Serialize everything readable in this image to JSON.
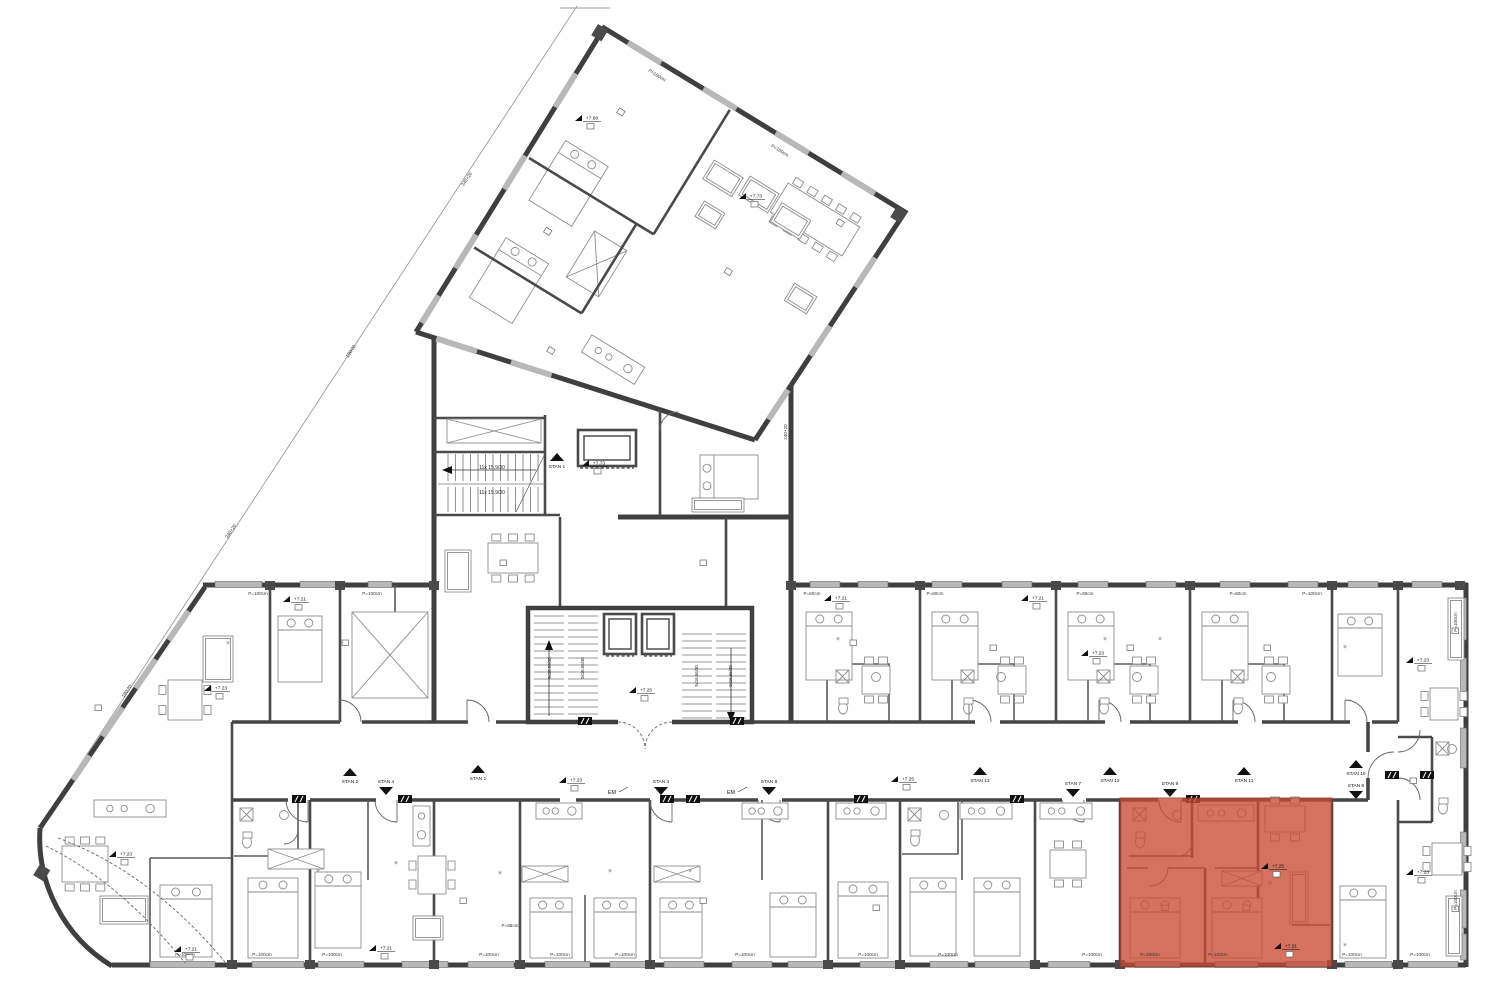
{
  "meta": {
    "drawing_type": "apartment building floor plan",
    "highlight_color": "#c94a33",
    "highlight_opacity": 0.78,
    "wall_color": "#3f3f3f",
    "window_color": "#b8b8b8"
  },
  "highlight": {
    "x": 1120,
    "y": 798,
    "w": 212,
    "h": 169
  },
  "stair_texts": {
    "upper": [
      {
        "text": "11x 15.9/30",
        "x": 492,
        "y": 469
      },
      {
        "text": "11x 15.9/30",
        "x": 492,
        "y": 494
      }
    ],
    "core": [
      {
        "text": "9x16.66/30",
        "x": 551,
        "y": 668
      },
      {
        "text": "9x16.66/30",
        "x": 584,
        "y": 668
      },
      {
        "text": "9x16.66/30",
        "x": 698,
        "y": 676
      },
      {
        "text": "9x16.66/30",
        "x": 732,
        "y": 676
      }
    ]
  },
  "stan_markers": [
    {
      "label": "STAN 2",
      "dir": "up",
      "x": 350,
      "y": 776
    },
    {
      "label": "STAN 1",
      "dir": "up",
      "x": 478,
      "y": 773
    },
    {
      "label": "STAN 13",
      "dir": "up",
      "x": 980,
      "y": 775
    },
    {
      "label": "STAN 12",
      "dir": "up",
      "x": 1110,
      "y": 775
    },
    {
      "label": "STAN 11",
      "dir": "up",
      "x": 1244,
      "y": 775
    },
    {
      "label": "STAN 10",
      "dir": "up",
      "x": 1356,
      "y": 768
    },
    {
      "label": "STAN 1",
      "dir": "up",
      "x": 557,
      "y": 461
    },
    {
      "label": "STAN 4",
      "dir": "down",
      "x": 386,
      "y": 787
    },
    {
      "label": "STAN 3",
      "dir": "down",
      "x": 661,
      "y": 787
    },
    {
      "label": "STAN 8",
      "dir": "down",
      "x": 769,
      "y": 787
    },
    {
      "label": "STAN 7",
      "dir": "down",
      "x": 1073,
      "y": 789
    },
    {
      "label": "STAN 9",
      "dir": "down",
      "x": 1170,
      "y": 789
    },
    {
      "label": "STAN 6",
      "dir": "down",
      "x": 1356,
      "y": 791
    }
  ],
  "elevation_markers": [
    {
      "label": "+7.73",
      "x": 591,
      "y": 463
    },
    {
      "label": "+7.73",
      "x": 748,
      "y": 196
    },
    {
      "label": "+7.68",
      "x": 584,
      "y": 118
    },
    {
      "label": "+7.23",
      "x": 568,
      "y": 780
    },
    {
      "label": "+7.25",
      "x": 900,
      "y": 779
    },
    {
      "label": "+7.25",
      "x": 638,
      "y": 690
    },
    {
      "label": "+7.23",
      "x": 118,
      "y": 854
    },
    {
      "label": "+7.21",
      "x": 183,
      "y": 949
    },
    {
      "label": "+7.21",
      "x": 292,
      "y": 599
    },
    {
      "label": "+7.21",
      "x": 833,
      "y": 598
    },
    {
      "label": "+7.21",
      "x": 1030,
      "y": 598
    },
    {
      "label": "+7.23",
      "x": 1090,
      "y": 653
    },
    {
      "label": "+7.25",
      "x": 1270,
      "y": 866
    },
    {
      "label": "+7.21",
      "x": 1283,
      "y": 946
    },
    {
      "label": "+7.23",
      "x": 1415,
      "y": 660
    },
    {
      "label": "+7.23",
      "x": 1415,
      "y": 872
    },
    {
      "label": "+7.23",
      "x": 213,
      "y": 688
    },
    {
      "label": "+7.21",
      "x": 378,
      "y": 948
    }
  ],
  "em_labels": [
    {
      "text": "EM",
      "x": 612,
      "y": 794
    },
    {
      "text": "EM",
      "x": 731,
      "y": 794
    }
  ],
  "wall_texts": [
    {
      "text": "P=100cm",
      "x": 185,
      "y": 956,
      "rot": 0
    },
    {
      "text": "P=100cm",
      "x": 262,
      "y": 956,
      "rot": 0
    },
    {
      "text": "P=100cm",
      "x": 332,
      "y": 956,
      "rot": 0
    },
    {
      "text": "P=100cm",
      "x": 489,
      "y": 956,
      "rot": 0
    },
    {
      "text": "P=100cm",
      "x": 560,
      "y": 956,
      "rot": 0
    },
    {
      "text": "P=100cm",
      "x": 625,
      "y": 956,
      "rot": 0
    },
    {
      "text": "P=100cm",
      "x": 745,
      "y": 956,
      "rot": 0
    },
    {
      "text": "P=100cm",
      "x": 868,
      "y": 956,
      "rot": 0
    },
    {
      "text": "P=100cm",
      "x": 948,
      "y": 956,
      "rot": 0
    },
    {
      "text": "P=100cm",
      "x": 1092,
      "y": 956,
      "rot": 0
    },
    {
      "text": "P=100cm",
      "x": 1150,
      "y": 956,
      "rot": 0
    },
    {
      "text": "P=100cm",
      "x": 1218,
      "y": 956,
      "rot": 0
    },
    {
      "text": "P=100cm",
      "x": 1352,
      "y": 956,
      "rot": 0
    },
    {
      "text": "P=100cm",
      "x": 1420,
      "y": 956,
      "rot": 0
    },
    {
      "text": "P=85cm",
      "x": 510,
      "y": 927,
      "rot": 0
    },
    {
      "text": "P=60cm",
      "x": 812,
      "y": 595,
      "rot": 0
    },
    {
      "text": "P=60cm",
      "x": 935,
      "y": 595,
      "rot": 0
    },
    {
      "text": "P=60cm",
      "x": 1085,
      "y": 595,
      "rot": 0
    },
    {
      "text": "P=60cm",
      "x": 1238,
      "y": 595,
      "rot": 0
    },
    {
      "text": "P=100cm",
      "x": 1312,
      "y": 595,
      "rot": 0
    },
    {
      "text": "P=100cm",
      "x": 258,
      "y": 595,
      "rot": 0
    },
    {
      "text": "P=100cm",
      "x": 372,
      "y": 595,
      "rot": 0
    },
    {
      "text": "P=100cm",
      "x": 1457,
      "y": 622,
      "rot": -90
    },
    {
      "text": "P=100cm",
      "x": 1457,
      "y": 900,
      "rot": -90
    },
    {
      "text": "240+20",
      "x": 468,
      "y": 180,
      "rot": -56
    },
    {
      "text": "180/20",
      "x": 352,
      "y": 352,
      "rot": -56
    },
    {
      "text": "240+20",
      "x": 232,
      "y": 532,
      "rot": -56
    },
    {
      "text": "180/20",
      "x": 128,
      "y": 692,
      "rot": -56
    },
    {
      "text": "240+20",
      "x": 787,
      "y": 432,
      "rot": -90
    }
  ],
  "wing_texts": [
    {
      "text": "P=100cm",
      "u": 70,
      "v": 14
    },
    {
      "text": "P=100cm",
      "u": 214,
      "v": 14
    }
  ],
  "windows": {
    "south": [
      [
        150,
        215
      ],
      [
        252,
        304
      ],
      [
        318,
        364
      ],
      [
        402,
        448
      ],
      [
        468,
        514
      ],
      [
        545,
        590
      ],
      [
        610,
        646
      ],
      [
        664,
        704
      ],
      [
        732,
        772
      ],
      [
        788,
        824
      ],
      [
        860,
        896
      ],
      [
        930,
        968
      ],
      [
        975,
        1030
      ],
      [
        1048,
        1090
      ],
      [
        1135,
        1180
      ],
      [
        1215,
        1258
      ],
      [
        1286,
        1328
      ],
      [
        1345,
        1392
      ],
      [
        1408,
        1458
      ]
    ],
    "north": [
      [
        215,
        262
      ],
      [
        300,
        336
      ],
      [
        368,
        392
      ],
      [
        810,
        840
      ],
      [
        858,
        888
      ],
      [
        932,
        962
      ],
      [
        1002,
        1032
      ],
      [
        1078,
        1108
      ],
      [
        1146,
        1176
      ],
      [
        1220,
        1250
      ],
      [
        1288,
        1318
      ],
      [
        1348,
        1378
      ],
      [
        1412,
        1442
      ]
    ],
    "east": [
      [
        598,
        640
      ],
      [
        658,
        700
      ],
      [
        728,
        768
      ],
      [
        832,
        872
      ],
      [
        890,
        928
      ],
      [
        934,
        960
      ]
    ],
    "diag": [
      [
        0.1,
        0.22
      ],
      [
        0.3,
        0.42
      ],
      [
        0.5,
        0.62
      ],
      [
        0.7,
        0.8
      ]
    ],
    "wing_top": [
      [
        0.08,
        0.19
      ],
      [
        0.33,
        0.44
      ],
      [
        0.57,
        0.68
      ],
      [
        0.79,
        0.9
      ]
    ],
    "wing_left": [
      [
        0.15,
        0.26
      ],
      [
        0.42,
        0.53
      ],
      [
        0.68,
        0.79
      ],
      [
        0.88,
        0.97
      ]
    ],
    "wing_right": [
      [
        0.2,
        0.33
      ],
      [
        0.5,
        0.63
      ],
      [
        0.78,
        0.91
      ]
    ],
    "wing_bottom": [
      [
        0.06,
        0.18
      ],
      [
        0.28,
        0.4
      ]
    ]
  },
  "piers": {
    "south": [
      232,
      310,
      434,
      520,
      650,
      828,
      900,
      1035,
      1120,
      1332,
      1398
    ],
    "north": [
      270,
      340,
      434,
      791,
      920,
      1056,
      1190,
      1332,
      1398,
      1460
    ]
  },
  "doors": {
    "south_x": [
      297,
      386,
      661,
      769,
      1073,
      1170
    ],
    "north_x": [
      350,
      478,
      980,
      1110,
      1244,
      1356
    ]
  },
  "ducts": [
    [
      292,
      795
    ],
    [
      398,
      795
    ],
    [
      660,
      795
    ],
    [
      686,
      795
    ],
    [
      854,
      795
    ],
    [
      1010,
      795
    ],
    [
      1186,
      795
    ],
    [
      1385,
      771
    ],
    [
      1420,
      771
    ],
    [
      578,
      717
    ],
    [
      730,
      717
    ]
  ],
  "room_tags": [
    [
      500,
      560
    ],
    [
      700,
      560
    ],
    [
      850,
      640
    ],
    [
      990,
      645
    ],
    [
      1127,
      645
    ],
    [
      1264,
      645
    ],
    [
      460,
      898
    ],
    [
      700,
      898
    ],
    [
      342,
      640
    ],
    [
      95,
      705
    ],
    [
      1162,
      905
    ],
    [
      1243,
      905
    ],
    [
      873,
      905
    ],
    [
      1410,
      778
    ],
    [
      1452,
      628
    ],
    [
      1452,
      906
    ]
  ],
  "wing_room_tags": [
    [
      55,
      60
    ],
    [
      55,
      200
    ],
    [
      230,
      140
    ],
    [
      300,
      40
    ],
    [
      120,
      300
    ]
  ],
  "furniture": [
    {
      "t": "bed",
      "x": 160,
      "y": 885,
      "w": 52,
      "h": 72
    },
    {
      "t": "bed",
      "x": 248,
      "y": 878,
      "w": 50,
      "h": 80
    },
    {
      "t": "bed",
      "x": 315,
      "y": 872,
      "w": 46,
      "h": 76
    },
    {
      "t": "bed",
      "x": 530,
      "y": 898,
      "w": 42,
      "h": 60
    },
    {
      "t": "bed",
      "x": 594,
      "y": 898,
      "w": 42,
      "h": 60
    },
    {
      "t": "bed",
      "x": 660,
      "y": 898,
      "w": 42,
      "h": 60
    },
    {
      "t": "bed",
      "x": 770,
      "y": 893,
      "w": 46,
      "h": 64
    },
    {
      "t": "bed",
      "x": 838,
      "y": 882,
      "w": 50,
      "h": 76
    },
    {
      "t": "bed",
      "x": 910,
      "y": 878,
      "w": 46,
      "h": 78
    },
    {
      "t": "bed",
      "x": 974,
      "y": 878,
      "w": 46,
      "h": 78
    },
    {
      "t": "bed",
      "x": 1130,
      "y": 898,
      "w": 50,
      "h": 60
    },
    {
      "t": "bed",
      "x": 1212,
      "y": 898,
      "w": 50,
      "h": 60
    },
    {
      "t": "bed",
      "x": 1340,
      "y": 886,
      "w": 46,
      "h": 72
    },
    {
      "t": "bed",
      "x": 806,
      "y": 612,
      "w": 46,
      "h": 68
    },
    {
      "t": "bed",
      "x": 932,
      "y": 612,
      "w": 46,
      "h": 68
    },
    {
      "t": "bed",
      "x": 1068,
      "y": 612,
      "w": 46,
      "h": 68
    },
    {
      "t": "bed",
      "x": 1202,
      "y": 612,
      "w": 46,
      "h": 68
    },
    {
      "t": "bed",
      "x": 1338,
      "y": 614,
      "w": 44,
      "h": 62
    },
    {
      "t": "bed",
      "x": 278,
      "y": 616,
      "w": 44,
      "h": 66
    },
    {
      "t": "bed",
      "x": 700,
      "y": 455,
      "w": 58,
      "h": 44
    },
    {
      "t": "table",
      "x": 62,
      "y": 846,
      "w": 46,
      "h": 36,
      "ch": 6
    },
    {
      "t": "table",
      "x": 168,
      "y": 680,
      "w": 34,
      "h": 40,
      "ch": 4
    },
    {
      "t": "table",
      "x": 418,
      "y": 856,
      "w": 28,
      "h": 38,
      "ch": 4
    },
    {
      "t": "table",
      "x": 488,
      "y": 543,
      "w": 50,
      "h": 30,
      "ch": 6
    },
    {
      "t": "table",
      "x": 862,
      "y": 666,
      "w": 28,
      "h": 28,
      "ch": 4
    },
    {
      "t": "table",
      "x": 998,
      "y": 666,
      "w": 28,
      "h": 28,
      "ch": 4
    },
    {
      "t": "table",
      "x": 1130,
      "y": 666,
      "w": 28,
      "h": 28,
      "ch": 4
    },
    {
      "t": "table",
      "x": 1262,
      "y": 666,
      "w": 28,
      "h": 28,
      "ch": 4
    },
    {
      "t": "table",
      "x": 1050,
      "y": 850,
      "w": 36,
      "h": 28,
      "ch": 4
    },
    {
      "t": "table",
      "x": 1265,
      "y": 806,
      "w": 40,
      "h": 26,
      "ch": 4
    },
    {
      "t": "table",
      "x": 1432,
      "y": 843,
      "w": 30,
      "h": 32,
      "ch": 4
    },
    {
      "t": "table",
      "x": 1430,
      "y": 688,
      "w": 28,
      "h": 32,
      "ch": 4
    },
    {
      "t": "sofa",
      "x": 203,
      "y": 636,
      "w": 30,
      "h": 46
    },
    {
      "t": "sofa",
      "x": 100,
      "y": 896,
      "w": 48,
      "h": 28
    },
    {
      "t": "sofa",
      "x": 445,
      "y": 550,
      "w": 26,
      "h": 42
    },
    {
      "t": "sofa",
      "x": 413,
      "y": 916,
      "w": 30,
      "h": 24
    },
    {
      "t": "sofa",
      "x": 1448,
      "y": 598,
      "w": 16,
      "h": 62
    },
    {
      "t": "sofa",
      "x": 1446,
      "y": 896,
      "w": 16,
      "h": 60
    },
    {
      "t": "sofa",
      "x": 1290,
      "y": 872,
      "w": 18,
      "h": 52
    },
    {
      "t": "sofa",
      "x": 692,
      "y": 498,
      "w": 52,
      "h": 14
    },
    {
      "t": "kitchen",
      "x": 94,
      "y": 800,
      "w": 72,
      "h": 17
    },
    {
      "t": "kitchen",
      "x": 413,
      "y": 806,
      "w": 17,
      "h": 40
    },
    {
      "t": "kitchen",
      "x": 536,
      "y": 803,
      "w": 46,
      "h": 16
    },
    {
      "t": "kitchen",
      "x": 742,
      "y": 803,
      "w": 46,
      "h": 16
    },
    {
      "t": "kitchen",
      "x": 836,
      "y": 803,
      "w": 50,
      "h": 16
    },
    {
      "t": "kitchen",
      "x": 960,
      "y": 803,
      "w": 52,
      "h": 16
    },
    {
      "t": "kitchen",
      "x": 1040,
      "y": 803,
      "w": 52,
      "h": 16
    },
    {
      "t": "kitchen",
      "x": 1198,
      "y": 805,
      "w": 56,
      "h": 16
    },
    {
      "t": "ward",
      "x": 268,
      "y": 849,
      "w": 56,
      "h": 20
    },
    {
      "t": "ward",
      "x": 352,
      "y": 612,
      "w": 76,
      "h": 86
    },
    {
      "t": "ward",
      "x": 447,
      "y": 419,
      "w": 94,
      "h": 24
    },
    {
      "t": "ward",
      "x": 1222,
      "y": 871,
      "w": 40,
      "h": 15
    },
    {
      "t": "ward",
      "x": 522,
      "y": 866,
      "w": 46,
      "h": 16
    },
    {
      "t": "ward",
      "x": 654,
      "y": 866,
      "w": 46,
      "h": 16
    },
    {
      "t": "bath",
      "x": 238,
      "y": 806,
      "w": 56,
      "h": 46
    },
    {
      "t": "bath",
      "x": 906,
      "y": 806,
      "w": 48,
      "h": 44
    },
    {
      "t": "bath",
      "x": 1131,
      "y": 806,
      "w": 56,
      "h": 46
    },
    {
      "t": "bath",
      "x": 834,
      "y": 668,
      "w": 52,
      "h": 50
    },
    {
      "t": "bath",
      "x": 959,
      "y": 668,
      "w": 52,
      "h": 50
    },
    {
      "t": "bath",
      "x": 1095,
      "y": 668,
      "w": 52,
      "h": 50
    },
    {
      "t": "bath",
      "x": 1229,
      "y": 668,
      "w": 52,
      "h": 50
    },
    {
      "t": "bath",
      "x": 1434,
      "y": 740,
      "w": 28,
      "h": 78
    },
    {
      "t": "sun",
      "x": 318,
      "y": 876
    },
    {
      "t": "sun",
      "x": 396,
      "y": 868
    },
    {
      "t": "sun",
      "x": 610,
      "y": 876
    },
    {
      "t": "sun",
      "x": 690,
      "y": 876
    },
    {
      "t": "sun",
      "x": 838,
      "y": 644
    },
    {
      "t": "sun",
      "x": 1105,
      "y": 644
    },
    {
      "t": "sun",
      "x": 1160,
      "y": 644
    },
    {
      "t": "sun",
      "x": 228,
      "y": 648
    },
    {
      "t": "sun",
      "x": 1270,
      "y": 888
    },
    {
      "t": "sun",
      "x": 500,
      "y": 878
    },
    {
      "t": "sun",
      "x": 1345,
      "y": 652
    },
    {
      "t": "sun",
      "x": 1345,
      "y": 950
    }
  ],
  "wing_furniture": [
    {
      "t": "bed",
      "x": 26,
      "y": 116,
      "w": 50,
      "h": 70
    },
    {
      "t": "bed",
      "x": 26,
      "y": 230,
      "w": 50,
      "h": 70
    },
    {
      "t": "ward",
      "x": 98,
      "y": 178,
      "w": 38,
      "h": 54
    },
    {
      "t": "table",
      "x": 238,
      "y": 36,
      "w": 84,
      "h": 34,
      "ch": 10
    },
    {
      "t": "kitchen",
      "x": 150,
      "y": 268,
      "w": 62,
      "h": 20
    },
    {
      "t": "sofa",
      "x": 163,
      "y": 55,
      "w": 34,
      "h": 22
    },
    {
      "t": "sofa",
      "x": 202,
      "y": 50,
      "w": 34,
      "h": 22
    },
    {
      "t": "sofa",
      "x": 243,
      "y": 56,
      "w": 34,
      "h": 22
    },
    {
      "t": "sofa",
      "x": 176,
      "y": 95,
      "w": 24,
      "h": 18
    },
    {
      "t": "sofa",
      "x": 296,
      "y": 118,
      "w": 26,
      "h": 20
    }
  ]
}
